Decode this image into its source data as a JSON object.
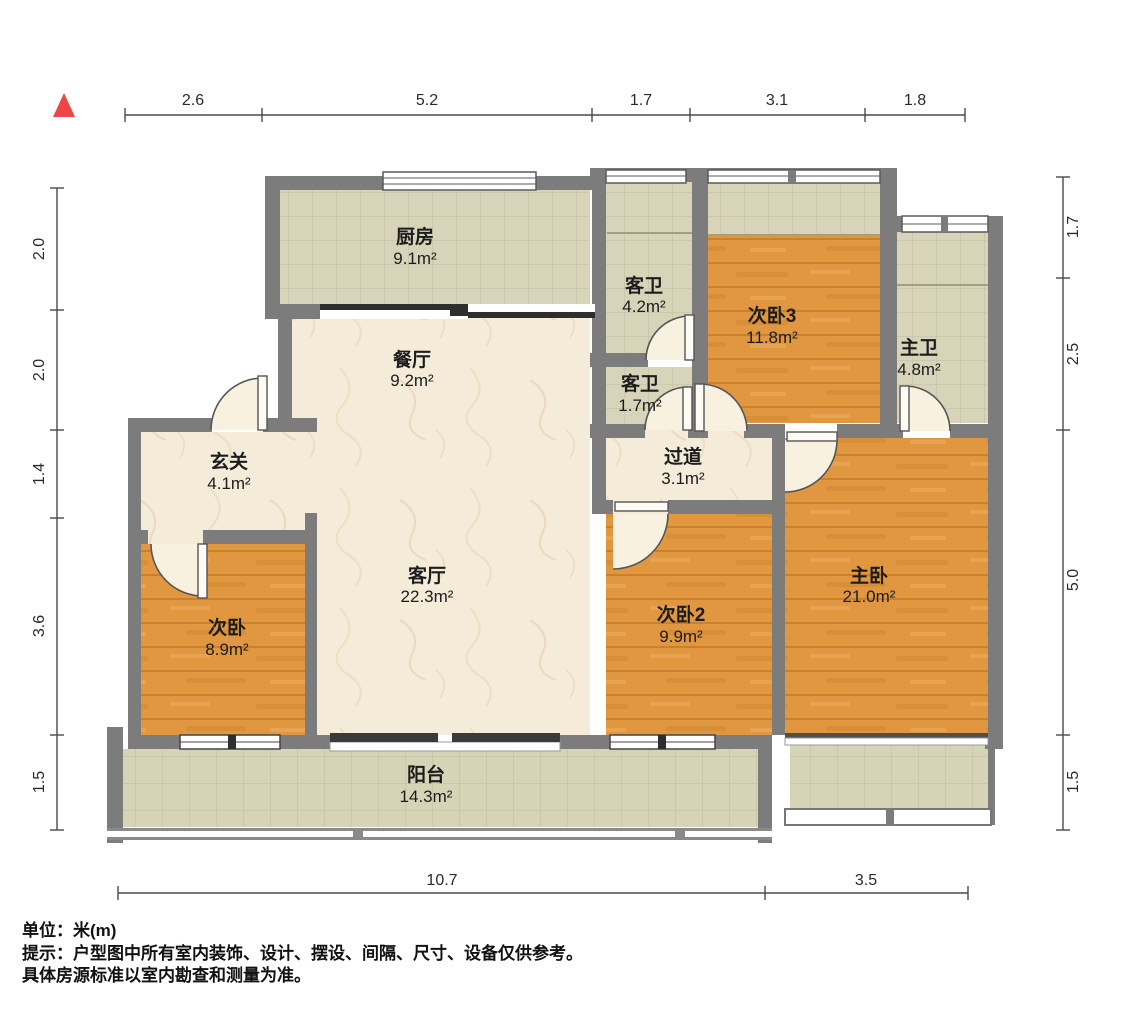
{
  "rooms": {
    "kitchen": {
      "name": "厨房",
      "area": "9.1m²"
    },
    "dining": {
      "name": "餐厅",
      "area": "9.2m²"
    },
    "living": {
      "name": "客厅",
      "area": "22.3m²"
    },
    "entry": {
      "name": "玄关",
      "area": "4.1m²"
    },
    "bedroom1": {
      "name": "次卧",
      "area": "8.9m²"
    },
    "bedroom2": {
      "name": "次卧2",
      "area": "9.9m²"
    },
    "bedroom3": {
      "name": "次卧3",
      "area": "11.8m²"
    },
    "master": {
      "name": "主卧",
      "area": "21.0m²"
    },
    "guest_bath": {
      "name": "客卫",
      "area": "4.2m²"
    },
    "guest_bath_small": {
      "name": "客卫",
      "area": "1.7m²"
    },
    "master_bath": {
      "name": "主卫",
      "area": "4.8m²"
    },
    "hallway": {
      "name": "过道",
      "area": "3.1m²"
    },
    "balcony": {
      "name": "阳台",
      "area": "14.3m²"
    }
  },
  "dims": {
    "top": [
      "2.6",
      "5.2",
      "1.7",
      "3.1",
      "1.8"
    ],
    "left": [
      "2.0",
      "2.0",
      "1.4",
      "3.6",
      "1.5"
    ],
    "right": [
      "1.7",
      "2.5",
      "5.0",
      "1.5"
    ],
    "bottom": [
      "10.7",
      "3.5"
    ]
  },
  "footer": {
    "unit": "单位：米(m)",
    "tip_line1": "提示：户型图中所有室内装饰、设计、摆设、间隔、尺寸、设备仅供参考。",
    "tip_line2": "具体房源标准以室内勘查和测量为准。"
  },
  "colors": {
    "wall": "#7c7c7c",
    "wood_floor": "#e0973f",
    "tile_floor": "#d8d4ba",
    "marble_floor": "#f4ecd9",
    "north_arrow": "#ee4545",
    "text": "#1c1c1c"
  }
}
